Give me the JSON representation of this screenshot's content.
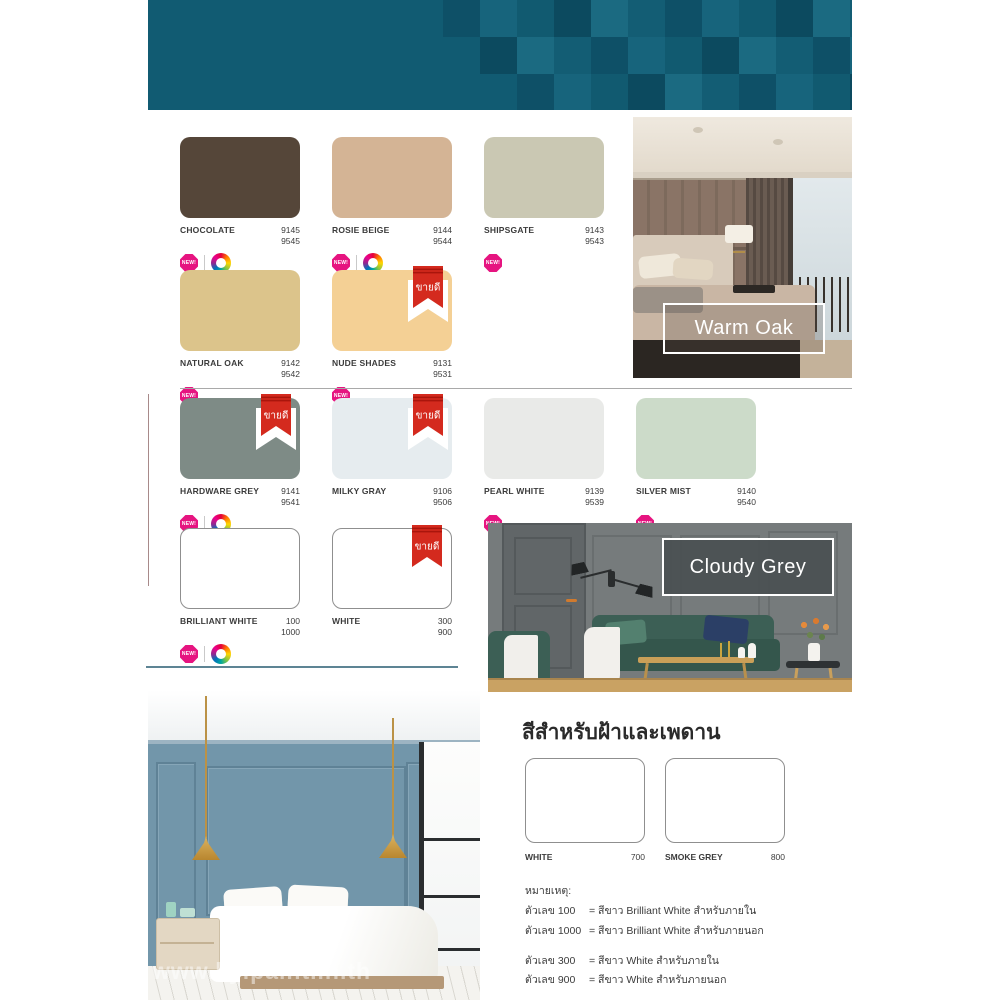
{
  "images": {
    "warm_oak": {
      "label": "Warm Oak"
    },
    "cloudy_grey": {
      "label": "Cloudy Grey"
    },
    "watermark": "www.kyipaint.in.th"
  },
  "palette": {
    "bestseller_ribbon_label": "ขายดี",
    "new_badge_label": "NEW!",
    "rows": [
      [
        {
          "name": "CHOCOLATE",
          "codes": [
            "9145",
            "9545"
          ],
          "color": "#554639",
          "new": true,
          "wheel": true
        },
        {
          "name": "ROSIE BEIGE",
          "codes": [
            "9144",
            "9544"
          ],
          "color": "#d4b495",
          "new": true,
          "wheel": true
        },
        {
          "name": "SHIPSGATE",
          "codes": [
            "9143",
            "9543"
          ],
          "color": "#cac8b3",
          "new": true
        }
      ],
      [
        {
          "name": "NATURAL OAK",
          "codes": [
            "9142",
            "9542"
          ],
          "color": "#dcc48b",
          "new": true
        },
        {
          "name": "NUDE SHADES",
          "codes": [
            "9131",
            "9531"
          ],
          "color": "#f4d095",
          "new": true,
          "bestseller": true
        }
      ],
      [
        {
          "name": "HARDWARE GREY",
          "codes": [
            "9141",
            "9541"
          ],
          "color": "#7e8b86",
          "new": true,
          "wheel": true,
          "bestseller": true
        },
        {
          "name": "MILKY GRAY",
          "codes": [
            "9106",
            "9506"
          ],
          "color": "#e6ecef",
          "bestseller": true
        },
        {
          "name": "PEARL WHITE",
          "codes": [
            "9139",
            "9539"
          ],
          "color": "#e9eae8",
          "new": true
        },
        {
          "name": "SILVER MIST",
          "codes": [
            "9140",
            "9540"
          ],
          "color": "#ccdbc9",
          "new": true
        }
      ],
      [
        {
          "name": "BRILLIANT WHITE",
          "codes": [
            "100",
            "1000"
          ],
          "color": "#ffffff",
          "outline": true,
          "new": true,
          "wheel": true
        },
        {
          "name": "WHITE",
          "codes": [
            "300",
            "900"
          ],
          "color": "#ffffff",
          "outline": true,
          "bestseller": true
        }
      ]
    ]
  },
  "ceiling_section": {
    "title": "สีสำหรับฝ้าและเพดาน",
    "swatches": [
      {
        "name": "WHITE",
        "code": "700",
        "color": "#ffffff"
      },
      {
        "name": "SMOKE GREY",
        "code": "800",
        "color": "#ffffff"
      }
    ]
  },
  "notes": {
    "title": "หมายเหตุ:",
    "groups": [
      [
        {
          "code": "ตัวเลข 100",
          "text": "= สีขาว Brilliant White สำหรับภายใน"
        },
        {
          "code": "ตัวเลข 1000",
          "text": "= สีขาว Brilliant White สำหรับภายนอก"
        }
      ],
      [
        {
          "code": "ตัวเลข 300",
          "text": "= สีขาว White สำหรับภายใน"
        },
        {
          "code": "ตัวเลข 900",
          "text": "= สีขาว White สำหรับภายนอก"
        }
      ]
    ],
    "wheel_note": "เฉดแม่สีพิเศษ และสีขาว Brilliant white"
  },
  "colors": {
    "header_teal": "#115b72",
    "badge_pink": "#e61480",
    "ribbon_red": "#d42a1e",
    "divider_blue": "#5d8494"
  }
}
